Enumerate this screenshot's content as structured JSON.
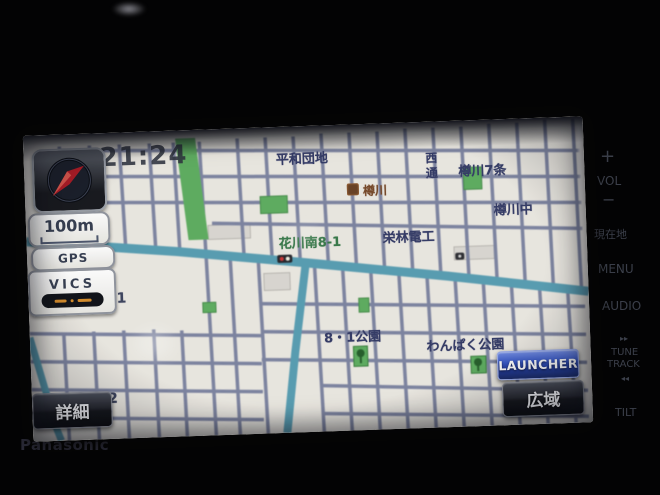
{
  "device": {
    "brand": "Panasonic",
    "side_buttons": [
      {
        "id": "vol-plus",
        "label": "+"
      },
      {
        "id": "vol",
        "label": "VOL"
      },
      {
        "id": "vol-minus",
        "label": "−"
      },
      {
        "id": "current-location",
        "label": "現在地"
      },
      {
        "id": "menu",
        "label": "MENU"
      },
      {
        "id": "audio",
        "label": "AUDIO"
      },
      {
        "id": "seek-forward",
        "label": "▸▸"
      },
      {
        "id": "tune",
        "label": "TUNE"
      },
      {
        "id": "track",
        "label": "TRACK"
      },
      {
        "id": "seek-back",
        "label": "◂◂"
      },
      {
        "id": "tilt",
        "label": "TILT"
      }
    ]
  },
  "status": {
    "clock": "21:24",
    "scale_label": "100m",
    "gps_label": "GPS",
    "vics_label": "VICS"
  },
  "buttons": {
    "detail": "詳細",
    "wide": "広域",
    "launcher": "LAUNCHER"
  },
  "map": {
    "colors": {
      "background": "#ece9e1",
      "minor_road": "#7b83a4",
      "major_road": "#4f9fb7",
      "park_green": "#55b057",
      "label_navy": "#31396b",
      "label_green": "#2f7a44"
    },
    "labels": [
      {
        "text": "平和団地"
      },
      {
        "text": "樽川7条"
      },
      {
        "text": "西通"
      },
      {
        "text": "樽川中"
      },
      {
        "text": "樽川"
      },
      {
        "text": "花川南8-1"
      },
      {
        "text": "栄林電工"
      },
      {
        "text": "8・1公園"
      },
      {
        "text": "わんぱく公園"
      },
      {
        "text": "1"
      },
      {
        "text": "2"
      }
    ]
  }
}
